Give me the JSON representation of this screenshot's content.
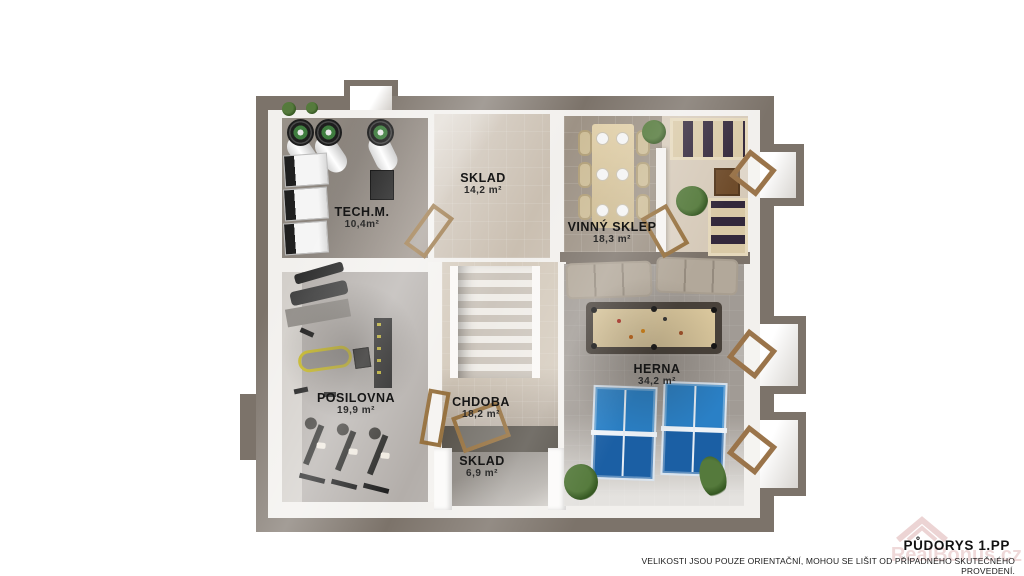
{
  "meta": {
    "title": "PŮDORYS 1.PP",
    "disclaimer": "VELIKOSTI JSOU POUZE ORIENTAČNÍ, MOHOU SE LIŠIT OD PŘÍPADNÉHO SKUTEČNÉHO PROVEDENÍ.",
    "watermark": "RealBonus.cz"
  },
  "rooms": [
    {
      "id": "techm",
      "name": "TECH.M.",
      "area": "10,4m²"
    },
    {
      "id": "sklad-top",
      "name": "SKLAD",
      "area": "14,2 m²"
    },
    {
      "id": "vinny-sklep",
      "name": "VINNÝ SKLEP",
      "area": "18,3 m²"
    },
    {
      "id": "posilovna",
      "name": "POSILOVNA",
      "area": "19,9 m²"
    },
    {
      "id": "chodba",
      "name": "CHDOBA",
      "area": "18,2 m²"
    },
    {
      "id": "sklad-bottom",
      "name": "SKLAD",
      "area": "6,9 m²"
    },
    {
      "id": "herna",
      "name": "HERNA",
      "area": "34,2 m²"
    }
  ],
  "colors": {
    "wall": "#7c736a",
    "floor_concrete": "#8f8a85",
    "floor_tile_beige": "#cabfb1",
    "floor_tile_gray": "#9d9285",
    "door_wood": "#96713f",
    "table_tennis_blue": "#2a80c6",
    "pool_felt": "#dcc99e",
    "sofa_beige": "#b2a89a",
    "plant_green": "#4a7a3a",
    "label_text": "#161616",
    "watermark_pink": "#d9a2a2"
  }
}
